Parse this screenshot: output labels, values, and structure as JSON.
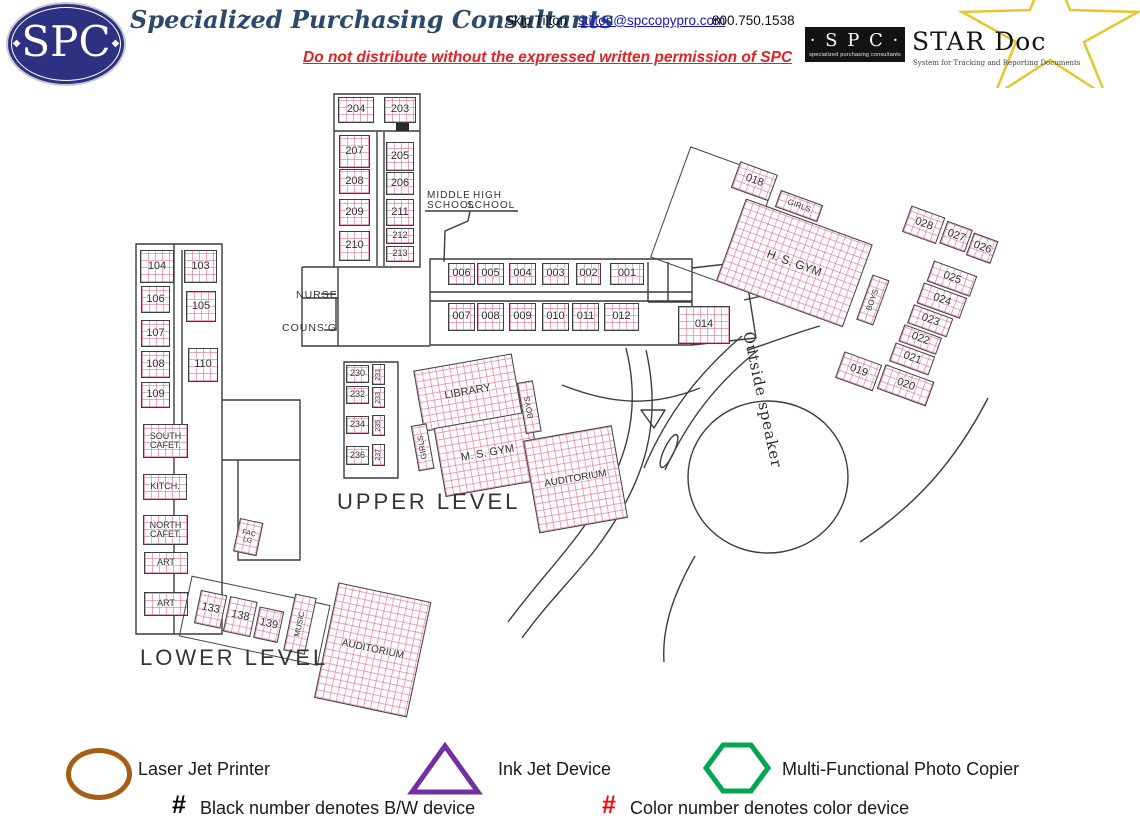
{
  "header": {
    "logo_text": "SPC",
    "company": "Specialized Purchasing Consultants",
    "contact_name": "Skip Tilton",
    "contact_email": "stilton@spccopypro.com",
    "contact_phone": "800.750.1538",
    "warning": "Do not distribute without the expressed written permission of SPC",
    "stardoc": {
      "spc": "· S P C ·",
      "spc_sub": "specialized purchasing consultants",
      "title": "STAR Doc",
      "subtitle": "System for Tracking and Reporting Documents"
    }
  },
  "colors": {
    "room_grid": "#E76A85",
    "line": "#3C3C3C",
    "navy": "#2E3081",
    "warning_red": "#E32222",
    "link_blue": "#1515C8",
    "star_yellow": "#E6C62F",
    "laser_brown": "#A65E17",
    "inkjet_purple": "#7030A0",
    "copier_green": "#00A651"
  },
  "map": {
    "groups": [
      {
        "name": "main",
        "x": 0,
        "y": 0,
        "w": 1140,
        "h": 828,
        "rot": 0,
        "rooms": [
          {
            "l": "204",
            "x": 338,
            "y": 97,
            "w": 36,
            "h": 26
          },
          {
            "l": "203",
            "x": 384,
            "y": 97,
            "w": 32,
            "h": 26
          },
          {
            "l": "207",
            "x": 339,
            "y": 135,
            "w": 31,
            "h": 33
          },
          {
            "l": "205",
            "x": 386,
            "y": 142,
            "w": 28,
            "h": 29
          },
          {
            "l": "208",
            "x": 339,
            "y": 169,
            "w": 31,
            "h": 25
          },
          {
            "l": "206",
            "x": 386,
            "y": 172,
            "w": 28,
            "h": 23
          },
          {
            "l": "209",
            "x": 339,
            "y": 199,
            "w": 31,
            "h": 27
          },
          {
            "l": "211",
            "x": 386,
            "y": 199,
            "w": 28,
            "h": 27
          },
          {
            "l": "210",
            "x": 339,
            "y": 231,
            "w": 31,
            "h": 30
          },
          {
            "l": "212",
            "x": 386,
            "y": 228,
            "w": 28,
            "h": 16,
            "fs": 9
          },
          {
            "l": "213",
            "x": 386,
            "y": 246,
            "w": 28,
            "h": 16,
            "fs": 9
          },
          {
            "l": "006",
            "x": 448,
            "y": 263,
            "w": 27,
            "h": 22
          },
          {
            "l": "005",
            "x": 477,
            "y": 263,
            "w": 27,
            "h": 22
          },
          {
            "l": "004",
            "x": 509,
            "y": 263,
            "w": 27,
            "h": 22
          },
          {
            "l": "003",
            "x": 542,
            "y": 263,
            "w": 27,
            "h": 22
          },
          {
            "l": "002",
            "x": 576,
            "y": 263,
            "w": 25,
            "h": 22
          },
          {
            "l": "001",
            "x": 610,
            "y": 263,
            "w": 34,
            "h": 22
          },
          {
            "l": "007",
            "x": 448,
            "y": 303,
            "w": 27,
            "h": 28
          },
          {
            "l": "008",
            "x": 477,
            "y": 303,
            "w": 27,
            "h": 28
          },
          {
            "l": "009",
            "x": 509,
            "y": 303,
            "w": 27,
            "h": 28
          },
          {
            "l": "010",
            "x": 542,
            "y": 303,
            "w": 27,
            "h": 28
          },
          {
            "l": "011",
            "x": 572,
            "y": 303,
            "w": 27,
            "h": 28
          },
          {
            "l": "012",
            "x": 604,
            "y": 303,
            "w": 35,
            "h": 28
          },
          {
            "l": "014",
            "x": 678,
            "y": 306,
            "w": 52,
            "h": 38
          },
          {
            "l": "104",
            "x": 140,
            "y": 250,
            "w": 34,
            "h": 33
          },
          {
            "l": "103",
            "x": 184,
            "y": 250,
            "w": 33,
            "h": 33
          },
          {
            "l": "106",
            "x": 141,
            "y": 286,
            "w": 29,
            "h": 27
          },
          {
            "l": "105",
            "x": 186,
            "y": 291,
            "w": 30,
            "h": 31
          },
          {
            "l": "107",
            "x": 141,
            "y": 320,
            "w": 29,
            "h": 27
          },
          {
            "l": "108",
            "x": 141,
            "y": 351,
            "w": 29,
            "h": 27
          },
          {
            "l": "110",
            "x": 188,
            "y": 348,
            "w": 30,
            "h": 34
          },
          {
            "l": "109",
            "x": 141,
            "y": 382,
            "w": 29,
            "h": 26
          },
          {
            "l": "SOUTH\nCAFET.",
            "x": 143,
            "y": 424,
            "w": 45,
            "h": 34,
            "fs": 9
          },
          {
            "l": "KITCH.",
            "x": 143,
            "y": 474,
            "w": 44,
            "h": 26,
            "fs": 9
          },
          {
            "l": "NORTH\nCAFET.",
            "x": 143,
            "y": 515,
            "w": 45,
            "h": 30,
            "fs": 9
          },
          {
            "l": "ART",
            "x": 144,
            "y": 552,
            "w": 44,
            "h": 22,
            "fs": 9
          },
          {
            "l": "ART",
            "x": 144,
            "y": 592,
            "w": 44,
            "h": 24,
            "fs": 9
          },
          {
            "l": "230",
            "x": 346,
            "y": 365,
            "w": 23,
            "h": 18,
            "fs": 9
          },
          {
            "l": "232",
            "x": 346,
            "y": 386,
            "w": 23,
            "h": 18,
            "fs": 9
          },
          {
            "l": "234",
            "x": 346,
            "y": 416,
            "w": 23,
            "h": 18,
            "fs": 9
          },
          {
            "l": "236",
            "x": 346,
            "y": 446,
            "w": 23,
            "h": 19,
            "fs": 9
          },
          {
            "l": "231",
            "x": 372,
            "y": 364,
            "w": 13,
            "h": 21,
            "fs": 7,
            "v": true
          },
          {
            "l": "233",
            "x": 372,
            "y": 387,
            "w": 13,
            "h": 21,
            "fs": 7,
            "v": true
          },
          {
            "l": "235",
            "x": 372,
            "y": 415,
            "w": 13,
            "h": 21,
            "fs": 7,
            "v": true
          },
          {
            "l": "237",
            "x": 372,
            "y": 444,
            "w": 13,
            "h": 22,
            "fs": 7,
            "v": true
          }
        ]
      },
      {
        "name": "middle",
        "x": 400,
        "y": 365,
        "w": 230,
        "h": 200,
        "rot": -10,
        "rooms": [
          {
            "l": "LIBRARY",
            "x": 12,
            "y": 8,
            "w": 100,
            "h": 62,
            "fs": 11
          },
          {
            "l": "GIRLS",
            "x": 0,
            "y": 62,
            "w": 16,
            "h": 46,
            "fs": 8,
            "v": true
          },
          {
            "l": "M. S. GYM",
            "x": 22,
            "y": 68,
            "w": 98,
            "h": 70,
            "fs": 11
          },
          {
            "l": "BOYS",
            "x": 112,
            "y": 38,
            "w": 16,
            "h": 52,
            "fs": 8,
            "v": true
          },
          {
            "l": "AUDITORIUM",
            "x": 108,
            "y": 96,
            "w": 90,
            "h": 94,
            "fs": 10
          }
        ]
      },
      {
        "name": "right",
        "x": 700,
        "y": 120,
        "w": 320,
        "h": 210,
        "rot": 20,
        "rooms": [
          {
            "l": "",
            "x": 0,
            "y": 28,
            "w": 92,
            "h": 118,
            "o": true
          },
          {
            "l": "018",
            "x": 52,
            "y": 25,
            "w": 40,
            "h": 28
          },
          {
            "l": "GIRLS",
            "x": 100,
            "y": 38,
            "w": 45,
            "h": 18,
            "fs": 8
          },
          {
            "l": "H. S. GYM",
            "x": 70,
            "y": 58,
            "w": 135,
            "h": 88,
            "fs": 12
          },
          {
            "l": "BOYS",
            "x": 215,
            "y": 86,
            "w": 18,
            "h": 48,
            "fs": 8,
            "v": true
          },
          {
            "l": "028",
            "x": 228,
            "y": 8,
            "w": 36,
            "h": 28
          },
          {
            "l": "027",
            "x": 267,
            "y": 10,
            "w": 27,
            "h": 24
          },
          {
            "l": "026",
            "x": 296,
            "y": 12,
            "w": 26,
            "h": 24
          },
          {
            "l": "025",
            "x": 268,
            "y": 52,
            "w": 46,
            "h": 22
          },
          {
            "l": "024",
            "x": 266,
            "y": 76,
            "w": 46,
            "h": 22
          },
          {
            "l": "023",
            "x": 264,
            "y": 100,
            "w": 42,
            "h": 20
          },
          {
            "l": "022",
            "x": 262,
            "y": 122,
            "w": 40,
            "h": 18
          },
          {
            "l": "021",
            "x": 260,
            "y": 142,
            "w": 42,
            "h": 20
          },
          {
            "l": "020",
            "x": 258,
            "y": 166,
            "w": 52,
            "h": 26
          },
          {
            "l": "019",
            "x": 215,
            "y": 168,
            "w": 40,
            "h": 28
          }
        ]
      },
      {
        "name": "lower",
        "x": 195,
        "y": 560,
        "w": 260,
        "h": 130,
        "rot": 12,
        "rooms": [
          {
            "l": "",
            "x": 0,
            "y": 16,
            "w": 142,
            "h": 62,
            "o": true
          },
          {
            "l": "133",
            "x": 12,
            "y": 28,
            "w": 27,
            "h": 34
          },
          {
            "l": "138",
            "x": 42,
            "y": 28,
            "w": 28,
            "h": 36
          },
          {
            "l": "139",
            "x": 73,
            "y": 32,
            "w": 25,
            "h": 32
          },
          {
            "l": "MUSIC",
            "x": 105,
            "y": 12,
            "w": 22,
            "h": 58,
            "fs": 8,
            "v": true
          },
          {
            "l": "AUDITORIUM",
            "x": 145,
            "y": -8,
            "w": 95,
            "h": 118,
            "fs": 10
          }
        ]
      },
      {
        "name": "faculty",
        "x": 240,
        "y": 518,
        "w": 30,
        "h": 40,
        "rot": 12,
        "rooms": [
          {
            "l": "FAC\nLG",
            "x": 0,
            "y": 0,
            "w": 24,
            "h": 34,
            "fs": 7
          }
        ]
      }
    ],
    "labels": [
      {
        "t": "NURSE",
        "x": 296,
        "y": 289,
        "fs": 10.5
      },
      {
        "t": "COUNS'G",
        "x": 282,
        "y": 322,
        "fs": 10.5
      },
      {
        "t": "MIDDLE",
        "x": 427,
        "y": 190,
        "fs": 10
      },
      {
        "t": "SCHOOL",
        "x": 427,
        "y": 200,
        "fs": 10
      },
      {
        "t": "HIGH",
        "x": 473,
        "y": 190,
        "fs": 10
      },
      {
        "t": "SCHOOL",
        "x": 467,
        "y": 200,
        "fs": 10
      },
      {
        "t": "UPPER LEVEL",
        "x": 337,
        "y": 489,
        "fs": 22,
        "ls": 3
      },
      {
        "t": "LOWER LEVEL",
        "x": 140,
        "y": 645,
        "fs": 22,
        "ls": 3
      },
      {
        "t": "Outside speaker",
        "x": 757,
        "y": 330,
        "fs": 15,
        "rot": 78,
        "serif": true
      }
    ]
  },
  "legend": {
    "items": [
      {
        "shape": "ellipse",
        "color": "#A65E17",
        "label": "Laser Jet Printer"
      },
      {
        "shape": "triangle",
        "color": "#7030A0",
        "label": "Ink Jet Device"
      },
      {
        "shape": "hexagon",
        "color": "#00A651",
        "label": "Multi-Functional Photo Copier"
      }
    ],
    "notes": [
      {
        "symbol": "#",
        "color": "#000000",
        "text": "Black number denotes B/W device"
      },
      {
        "symbol": "#",
        "color": "#FF0000",
        "text": "Color number denotes color device"
      }
    ]
  }
}
